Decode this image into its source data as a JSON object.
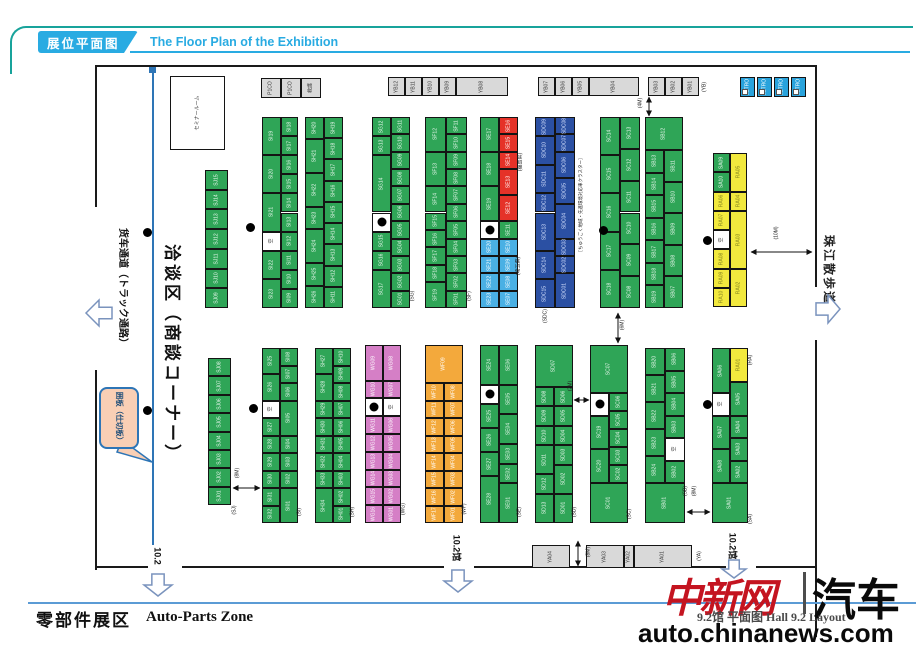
{
  "header": {
    "tab": "展位平面图",
    "title": "The Floor Plan of the Exhibition"
  },
  "footer": {
    "zone_cn": "零部件展区",
    "zone_en": "Auto-Parts Zone",
    "hall_caption": "9.2馆 平面图 Hall 9.2 Layout",
    "site": "auto.chinanews.com",
    "logo_cn": "中新网",
    "logo_car": "汽车"
  },
  "colors": {
    "accent_cyan": "#29abe2",
    "frame_teal": "#18a39b",
    "booth_green": "#2fa557",
    "booth_red": "#e53228",
    "booth_lightblue": "#4ab0e4",
    "booth_darkblue": "#2b50a3",
    "booth_pink": "#d57fc6",
    "booth_orange": "#f3a93c",
    "booth_yellow": "#f2e93e",
    "service_gray": "#d9d9d9",
    "partition_blue": "#2e75b6",
    "logo_red": "#c41420"
  },
  "plan": {
    "walls": [
      {
        "x": 95,
        "y": 65,
        "w": 722,
        "h": 2
      },
      {
        "x": 95,
        "y": 65,
        "w": 2,
        "h": 142
      },
      {
        "x": 95,
        "y": 370,
        "w": 2,
        "h": 200
      },
      {
        "x": 95,
        "y": 566,
        "w": 53,
        "h": 2
      },
      {
        "x": 182,
        "y": 566,
        "w": 262,
        "h": 2
      },
      {
        "x": 474,
        "y": 566,
        "w": 252,
        "h": 2
      },
      {
        "x": 756,
        "y": 566,
        "w": 61,
        "h": 2
      },
      {
        "x": 815,
        "y": 65,
        "w": 2,
        "h": 222
      },
      {
        "x": 815,
        "y": 340,
        "w": 2,
        "h": 297
      }
    ],
    "partition": {
      "x": 152,
      "y": 70,
      "h": 475,
      "marker": {
        "x": 149,
        "y": 67,
        "w": 7,
        "h": 6
      }
    },
    "columns": [
      {
        "x": 170,
        "y": 76,
        "w": 55,
        "h": 74,
        "cells": [
          "セミナールーム|w"
        ]
      },
      {
        "x": 205,
        "y": 170,
        "w": 23,
        "h": 138,
        "cells": [
          "SJ15",
          "SJ14",
          "SJ13",
          "SJ12",
          "SJ11",
          "SJ10",
          "SJ09"
        ]
      },
      {
        "x": 262,
        "y": 117,
        "w": 19,
        "h": 191,
        "cells": [
          "SI19||2",
          "SI20||2",
          "SI21||2",
          "空|w|1",
          "SI22||1.5",
          "SI23||1.5"
        ]
      },
      {
        "x": 281,
        "y": 117,
        "w": 17,
        "h": 191,
        "cells": [
          "SI18",
          "SI17",
          "SI16",
          "SI15",
          "SI14",
          "SI13",
          "SI12",
          "SI11",
          "SI10",
          "SI09"
        ]
      },
      {
        "x": 305,
        "y": 117,
        "w": 19,
        "h": 191,
        "cells": [
          "SH20",
          "SH21||1.5",
          "SH22||1.5",
          "SH23",
          "SH24||1.5",
          "SH25",
          "SH26"
        ]
      },
      {
        "x": 324,
        "y": 117,
        "w": 19,
        "h": 191,
        "cells": [
          "SH19",
          "SH18",
          "SH17",
          "SH16",
          "SH15",
          "SH14",
          "SH13",
          "SH12",
          "SH11"
        ]
      },
      {
        "x": 372,
        "y": 117,
        "w": 19,
        "h": 191,
        "cells": [
          "SG12",
          "SG13",
          "SG14||3",
          "●|e|1",
          "SG15",
          "SG16",
          "SG17||2"
        ]
      },
      {
        "x": 391,
        "y": 117,
        "w": 19,
        "h": 191,
        "cells": [
          "SG11",
          "SG10",
          "SG09",
          "SG08",
          "SG07",
          "SG06",
          "SG05",
          "SG04",
          "SG03",
          "SG02",
          "SG01"
        ]
      },
      {
        "x": 425,
        "y": 117,
        "w": 21,
        "h": 191,
        "cells": [
          "SF12||2",
          "SF13||2",
          "SF14||1.5",
          "SF15",
          "SF16",
          "SF17",
          "SF18",
          "SF19||1.5"
        ]
      },
      {
        "x": 446,
        "y": 117,
        "w": 21,
        "h": 191,
        "cells": [
          "SF11",
          "SF10",
          "SF09",
          "SF08",
          "SF07",
          "SF06",
          "SF05",
          "SF04",
          "SF03",
          "SF02",
          "SF01"
        ]
      },
      {
        "x": 480,
        "y": 117,
        "w": 19,
        "h": 191,
        "cells": [
          "SE17||2",
          "SE18||2",
          "SE19||2",
          "●|e|1",
          "SE20|b",
          "SE21|b",
          "SE22|b",
          "SE23|b"
        ]
      },
      {
        "x": 499,
        "y": 117,
        "w": 19,
        "h": 191,
        "cells": [
          "SE16|r",
          "SE15|r",
          "SE14|r",
          "SE13|r|1.5",
          "SE12|r|1.5",
          "SE11",
          "SE10|b",
          "SE09|b",
          "SE08|b",
          "SE07|b"
        ]
      },
      {
        "x": 535,
        "y": 117,
        "w": 20,
        "h": 191,
        "cells": [
          "SDC09|d",
          "SDC10|d|1.5",
          "SDC11|d|1.5",
          "SDC12|d",
          "SDC13|d|2",
          "SDC14|d|1.5",
          "SDC15|d|1.5"
        ]
      },
      {
        "x": 555,
        "y": 117,
        "w": 20,
        "h": 191,
        "cells": [
          "SDC08|d",
          "SDC07|d",
          "SDC06|d|1.5",
          "SDC05|d|1.5",
          "SDC04|d|2",
          "SDC03|d",
          "SDC02|d",
          "SDC01|d|2"
        ]
      },
      {
        "x": 600,
        "y": 117,
        "w": 20,
        "h": 191,
        "cells": [
          "SC14",
          "SC15",
          "SC16",
          "SC17",
          "SC18"
        ]
      },
      {
        "x": 620,
        "y": 117,
        "w": 20,
        "h": 191,
        "cells": [
          "SC13",
          "SC12",
          "SC11",
          "SC10",
          "SC09",
          "SC08"
        ]
      },
      {
        "x": 645,
        "y": 117,
        "w": 38,
        "h": 33,
        "cells": [
          "SB12"
        ]
      },
      {
        "x": 645,
        "y": 150,
        "w": 19,
        "h": 158,
        "cells": [
          "SB13",
          "SB14",
          "SB15",
          "SB16",
          "SB17",
          "SB18",
          "SB19"
        ]
      },
      {
        "x": 664,
        "y": 150,
        "w": 19,
        "h": 158,
        "cells": [
          "SB11",
          "SB10",
          "SB09",
          "SB08",
          "SB07"
        ]
      },
      {
        "x": 713,
        "y": 153,
        "w": 17,
        "h": 154,
        "cells": [
          "SA09",
          "SA10",
          "RA06|y",
          "RA07|y",
          "空|w",
          "RA08|y",
          "RA09|y",
          "RA10|y"
        ]
      },
      {
        "x": 730,
        "y": 153,
        "w": 17,
        "h": 154,
        "cells": [
          "RA05|y|2",
          "RA04|y",
          "RA03|y|3",
          "RA02|y|2"
        ]
      },
      {
        "x": 208,
        "y": 358,
        "w": 23,
        "h": 147,
        "cells": [
          "SJ08",
          "SJ07",
          "SJ06",
          "SJ05",
          "SJ04",
          "SJ03",
          "SJ02",
          "SJ01"
        ]
      },
      {
        "x": 262,
        "y": 348,
        "w": 18,
        "h": 175,
        "cells": [
          "SI25||1.5",
          "SI26||1.5",
          "空|w|1",
          "SI27",
          "SI28",
          "SI29",
          "SI30",
          "SI31",
          "SI32"
        ]
      },
      {
        "x": 280,
        "y": 348,
        "w": 18,
        "h": 175,
        "cells": [
          "SI08",
          "SI07",
          "SI06",
          "SI05||2",
          "SI04",
          "SI03",
          "SI02",
          "SI01||2"
        ]
      },
      {
        "x": 315,
        "y": 348,
        "w": 18,
        "h": 175,
        "cells": [
          "SH27||1.5",
          "SH28||1.5",
          "SH29",
          "SH30",
          "SH31",
          "SH32",
          "SH33",
          "SH34||2"
        ]
      },
      {
        "x": 333,
        "y": 348,
        "w": 18,
        "h": 175,
        "cells": [
          "SH10",
          "SH09",
          "SH08",
          "SH07",
          "SH06",
          "SH05",
          "SH04",
          "SH03",
          "SH02",
          "SH01"
        ]
      },
      {
        "x": 365,
        "y": 345,
        "w": 18,
        "h": 178,
        "cells": [
          "WG09|p|2",
          "WG10|p",
          "●|e",
          "WG11|p",
          "WG12|p",
          "WG13|p",
          "WG14|p",
          "WG15|p",
          "WG16|p"
        ]
      },
      {
        "x": 383,
        "y": 345,
        "w": 18,
        "h": 178,
        "cells": [
          "WG08|p|2",
          "WG07|p",
          "空|w",
          "WG06|p",
          "WG05|p",
          "WG04|p",
          "WG03|p",
          "WG02|p",
          "WG01|p"
        ]
      },
      {
        "x": 425,
        "y": 345,
        "w": 38,
        "h": 38,
        "cells": [
          "WF09|o"
        ]
      },
      {
        "x": 425,
        "y": 383,
        "w": 19,
        "h": 140,
        "cells": [
          "WF10|o",
          "WF11|o",
          "WF12|o",
          "WF13|o",
          "WF14|o",
          "WF15|o",
          "WF16|o",
          "WF17|o"
        ]
      },
      {
        "x": 444,
        "y": 383,
        "w": 19,
        "h": 140,
        "cells": [
          "WF08|o",
          "WF07|o",
          "WF06|o",
          "WF05|o",
          "WF04|o",
          "WF03|o",
          "WF02|o",
          "WF01|o"
        ]
      },
      {
        "x": 480,
        "y": 345,
        "w": 19,
        "h": 178,
        "cells": [
          "SE24||2",
          "●|e|1",
          "SE25||1.2",
          "SE26||1.2",
          "SE27||1.2",
          "SE28||2.4"
        ]
      },
      {
        "x": 499,
        "y": 345,
        "w": 19,
        "h": 178,
        "cells": [
          "SE06||2",
          "SE05||1.5",
          "SE04||1.5",
          "SE03",
          "SE02",
          "SE01||2"
        ]
      },
      {
        "x": 535,
        "y": 345,
        "w": 38,
        "h": 42,
        "cells": [
          "SD07"
        ]
      },
      {
        "x": 535,
        "y": 387,
        "w": 19,
        "h": 136,
        "cells": [
          "SD08",
          "SD09",
          "SD10",
          "SD11||1.5",
          "SD12",
          "SD13||1.5"
        ]
      },
      {
        "x": 554,
        "y": 387,
        "w": 19,
        "h": 136,
        "cells": [
          "SD06",
          "SD05",
          "SD04",
          "SD03",
          "SD02||1.5",
          "SD01||1.5"
        ]
      },
      {
        "x": 590,
        "y": 345,
        "w": 38,
        "h": 48,
        "cells": [
          "SC07"
        ]
      },
      {
        "x": 590,
        "y": 393,
        "w": 19,
        "h": 90,
        "cells": [
          "●|e|1",
          "SC19||1.5",
          "SC20||1.5"
        ]
      },
      {
        "x": 609,
        "y": 393,
        "w": 19,
        "h": 90,
        "cells": [
          "SC06",
          "SC05",
          "SC04",
          "SC03",
          "SC02"
        ]
      },
      {
        "x": 590,
        "y": 483,
        "w": 38,
        "h": 40,
        "cells": [
          "SC01"
        ]
      },
      {
        "x": 645,
        "y": 348,
        "w": 20,
        "h": 135,
        "cells": [
          "SB20",
          "SB21",
          "SB22",
          "SB23",
          "SB24"
        ]
      },
      {
        "x": 665,
        "y": 348,
        "w": 20,
        "h": 135,
        "cells": [
          "SB06",
          "SB05",
          "SB04",
          "SB03",
          "空|w",
          "SB02"
        ]
      },
      {
        "x": 645,
        "y": 483,
        "w": 40,
        "h": 40,
        "cells": [
          "SB01"
        ]
      },
      {
        "x": 712,
        "y": 348,
        "w": 18,
        "h": 135,
        "cells": [
          "SA06||2",
          "空|w|1",
          "SA07||1.5",
          "SA08||1.5"
        ]
      },
      {
        "x": 730,
        "y": 348,
        "w": 18,
        "h": 135,
        "cells": [
          "RA01|y|1.5",
          "SA05||1.5",
          "SA04",
          "SA03",
          "SA02"
        ]
      },
      {
        "x": 712,
        "y": 483,
        "w": 36,
        "h": 40,
        "cells": [
          "SA01"
        ]
      }
    ],
    "rows": [
      {
        "x": 261,
        "y": 78,
        "h": 20,
        "g": 0,
        "cells": [
          "P1CO|20|G",
          "P1CO|20|G",
          "救護|20|G"
        ]
      },
      {
        "x": 388,
        "y": 77,
        "h": 19,
        "g": 0,
        "cells": [
          "YB12|17|G",
          "YB11|17|G",
          "YB10|17|G",
          "YB09|17|G",
          "YB08|52|G"
        ]
      },
      {
        "x": 538,
        "y": 77,
        "h": 19,
        "g": 0,
        "cells": [
          "YB07|17|G",
          "YB06|17|G",
          "YB05|17|G",
          "YB04|50|G"
        ]
      },
      {
        "x": 648,
        "y": 77,
        "h": 19,
        "g": 0,
        "cells": [
          "YB03|17|G",
          "YB02|17|G",
          "YB01|17|G"
        ]
      },
      {
        "x": 740,
        "y": 77,
        "h": 20,
        "g": 2,
        "cells": [
          "JETRO|15|j",
          "JETRO|15|j",
          "JETRO|15|j",
          "JETRO|15|j"
        ]
      },
      {
        "x": 532,
        "y": 545,
        "h": 23,
        "g": 0,
        "cells": [
          "YA04|38|G"
        ]
      },
      {
        "x": 586,
        "y": 545,
        "h": 23,
        "g": 0,
        "cells": [
          "YA03|38|G",
          "YA02|10|G",
          "YA01|58|G"
        ]
      }
    ],
    "labels": [
      {
        "t": "(SG)",
        "x": 413,
        "y": 296
      },
      {
        "t": "(SF)",
        "x": 470,
        "y": 296
      },
      {
        "t": "(福島県)",
        "x": 521,
        "y": 162
      },
      {
        "t": "(埼玉県)",
        "x": 519,
        "y": 266
      },
      {
        "t": "［ちゅうごく地域・先進環境対応車クラスター］",
        "x": 581,
        "y": 205,
        "s": 4.5
      },
      {
        "t": "(SDC)",
        "x": 546,
        "y": 316
      },
      {
        "t": "(SJ)",
        "x": 235,
        "y": 510
      },
      {
        "t": "(SI)",
        "x": 300,
        "y": 512
      },
      {
        "t": "(SH)",
        "x": 353,
        "y": 512
      },
      {
        "t": "(WG)",
        "x": 404,
        "y": 509
      },
      {
        "t": "(WF)",
        "x": 465,
        "y": 509
      },
      {
        "t": "(SE)",
        "x": 520,
        "y": 512
      },
      {
        "t": "(SD)",
        "x": 575,
        "y": 512
      },
      {
        "t": "(SC)",
        "x": 630,
        "y": 514
      },
      {
        "t": "(SA)",
        "x": 751,
        "y": 519
      },
      {
        "t": "(RA)",
        "x": 751,
        "y": 360
      },
      {
        "t": "(YA)",
        "x": 700,
        "y": 556
      },
      {
        "t": "(YB)",
        "x": 705,
        "y": 87
      },
      {
        "t": "(4M)",
        "x": 641,
        "y": 103
      },
      {
        "t": "(10M)",
        "x": 777,
        "y": 233
      },
      {
        "t": "(6M)",
        "x": 623,
        "y": 325
      },
      {
        "t": "(2M)",
        "x": 571,
        "y": 386
      },
      {
        "t": "(8M)",
        "x": 238,
        "y": 473
      },
      {
        "t": "(SB)",
        "x": 686,
        "y": 491
      },
      {
        "t": "(8M)",
        "x": 695,
        "y": 491
      },
      {
        "t": "(8M)",
        "x": 589,
        "y": 552
      },
      {
        "t": "货车通道（トラック通路）",
        "x": 122,
        "y": 288,
        "r": 90,
        "s": 10,
        "b": 1,
        "c": "#111"
      },
      {
        "t": "洽谈区（商談コーナー）",
        "x": 172,
        "y": 354,
        "r": 90,
        "s": 17,
        "b": 1,
        "ls": 3,
        "c": "#111"
      },
      {
        "t": "珠江散歩道",
        "x": 829,
        "y": 270,
        "r": 90,
        "s": 12,
        "b": 1,
        "ls": 2,
        "c": "#222"
      },
      {
        "t": "10.2",
        "x": 157,
        "y": 556,
        "r": 90,
        "s": 9,
        "b": 1,
        "c": "#111"
      },
      {
        "t": "10.2馆",
        "x": 456,
        "y": 548,
        "r": 90,
        "s": 9,
        "b": 1,
        "c": "#111"
      },
      {
        "t": "10.2馆",
        "x": 732,
        "y": 546,
        "r": 90,
        "s": 9,
        "b": 1,
        "c": "#111"
      }
    ],
    "dots": [
      {
        "x": 147,
        "y": 232
      },
      {
        "x": 147,
        "y": 410
      },
      {
        "x": 250,
        "y": 227
      },
      {
        "x": 603,
        "y": 230
      },
      {
        "x": 707,
        "y": 240
      },
      {
        "x": 253,
        "y": 408
      },
      {
        "x": 707,
        "y": 404
      }
    ],
    "measures": [
      {
        "x1": 649,
        "y1": 97,
        "x2": 649,
        "y2": 116
      },
      {
        "x1": 751,
        "y1": 252,
        "x2": 812,
        "y2": 252
      },
      {
        "x1": 618,
        "y1": 313,
        "x2": 618,
        "y2": 343
      },
      {
        "x1": 574,
        "y1": 400,
        "x2": 589,
        "y2": 400
      },
      {
        "x1": 233,
        "y1": 488,
        "x2": 260,
        "y2": 488
      },
      {
        "x1": 687,
        "y1": 512,
        "x2": 710,
        "y2": 512
      },
      {
        "x1": 578,
        "y1": 541,
        "x2": 578,
        "y2": 566
      }
    ],
    "big_arrows": [
      {
        "x": 86,
        "y": 300,
        "w": 26,
        "h": 26,
        "dir": "left"
      },
      {
        "x": 816,
        "y": 295,
        "w": 24,
        "h": 28,
        "dir": "right"
      },
      {
        "x": 144,
        "y": 574,
        "w": 28,
        "h": 22,
        "dir": "down"
      },
      {
        "x": 444,
        "y": 570,
        "w": 28,
        "h": 22,
        "dir": "down"
      },
      {
        "x": 722,
        "y": 560,
        "w": 24,
        "h": 18,
        "dir": "down"
      }
    ],
    "callout": {
      "box": {
        "x": 99,
        "y": 387,
        "w": 36,
        "h": 58
      },
      "text": "囲板（仕切板）",
      "tail": "122,440 152,462 117,452"
    }
  }
}
